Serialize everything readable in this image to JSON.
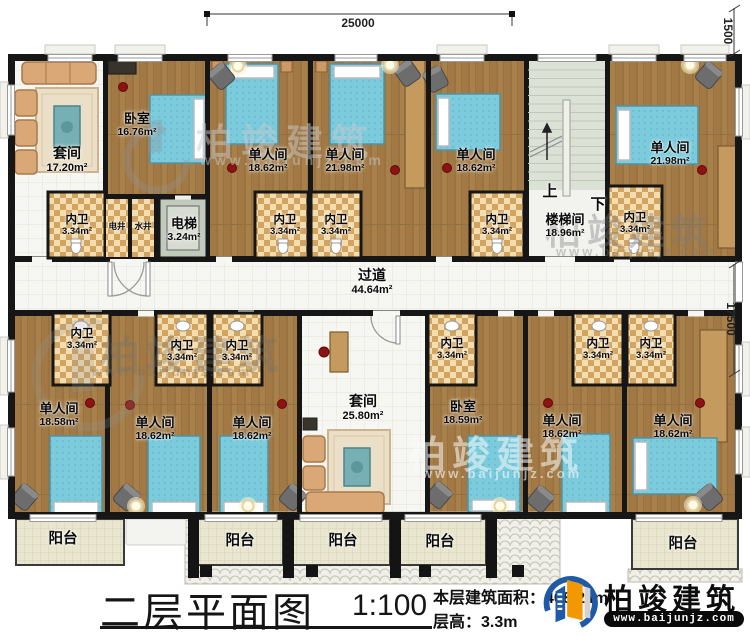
{
  "plan": {
    "rooms": [
      {
        "name": "套间",
        "area": "17.20m²"
      },
      {
        "name": "卧室",
        "area": "16.76m²"
      },
      {
        "name": "单人间",
        "area": "18.62m²"
      },
      {
        "name": "单人间",
        "area": "21.98m²"
      },
      {
        "name": "单人间",
        "area": "18.62m²"
      },
      {
        "name": "楼梯间",
        "area": "18.96m²"
      },
      {
        "name": "单人间",
        "area": "21.98m²"
      },
      {
        "name": "单人间",
        "area": "18.58m²"
      },
      {
        "name": "单人间",
        "area": "18.62m²"
      },
      {
        "name": "单人间",
        "area": "18.62m²"
      },
      {
        "name": "套间",
        "area": "25.80m²"
      },
      {
        "name": "卧室",
        "area": "18.59m²"
      },
      {
        "name": "单人间",
        "area": "18.62m²"
      },
      {
        "name": "单人间",
        "area": "18.62m²"
      }
    ],
    "corridor": {
      "name": "过道",
      "area": "44.64m²"
    },
    "elevator": {
      "name": "电梯",
      "area": "3.24m²"
    },
    "bathroom": {
      "name": "内卫",
      "area": "3.34m²"
    },
    "shaft_electric": "电井",
    "shaft_water": "水井",
    "stair_up": "上",
    "stair_down": "下",
    "balcony": "阳台",
    "dim_width": "25000",
    "dim_right_top": "1500",
    "dim_height": "17500"
  },
  "titleblock": {
    "title": "二层平面图",
    "scale": "1:100",
    "area_label": "本层建筑面积：",
    "area_value": "408.24m²",
    "floor_height_label": "层高：",
    "floor_height_value": "3.3m"
  },
  "brand": {
    "name": "柏竣建筑",
    "website": "www.baijunjz.com"
  },
  "watermark": {
    "text": "柏竣建筑",
    "website": "www.baijunjz.com"
  }
}
